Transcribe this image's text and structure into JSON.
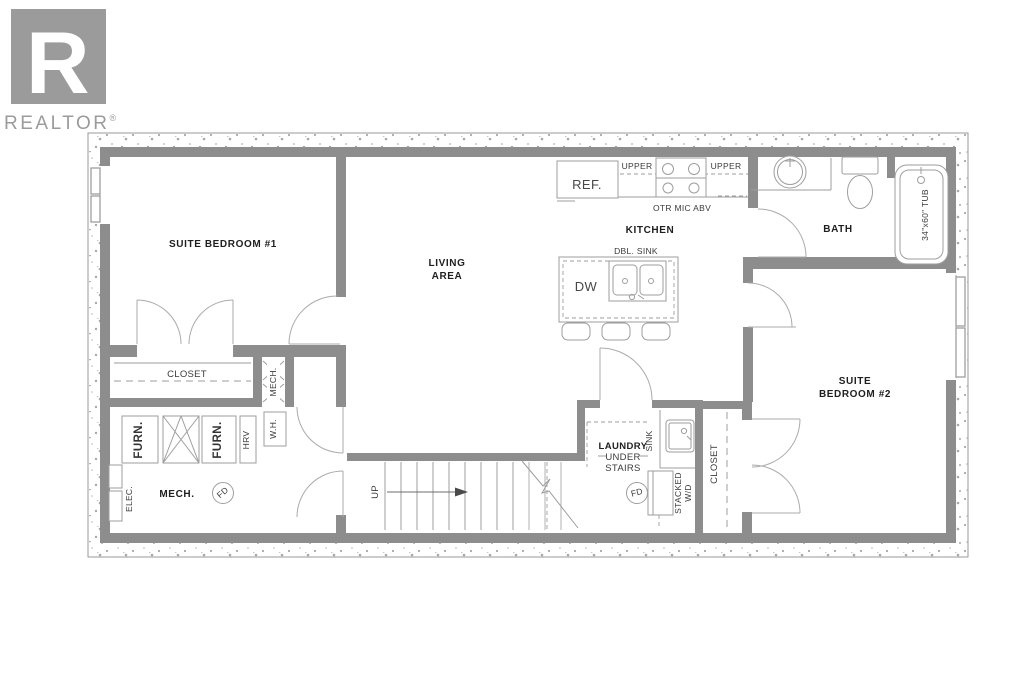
{
  "logo": {
    "letter": "R",
    "wordmark": "REALTOR",
    "registered": "®"
  },
  "rooms": {
    "bedroom1": "SUITE BEDROOM #1",
    "living_line1": "LIVING",
    "living_line2": "AREA",
    "kitchen": "KITCHEN",
    "bath": "BATH",
    "bedroom2_line1": "SUITE",
    "bedroom2_line2": "BEDROOM #2",
    "mech": "MECH.",
    "mech_chase": "MECH.",
    "laundry_line1": "LAUNDRY",
    "laundry_line2": "UNDER",
    "laundry_line3": "STAIRS",
    "closet_bedroom1": "CLOSET",
    "closet_bedroom2": "CLOSET"
  },
  "fixtures": {
    "ref": "REF.",
    "upper_left": "UPPER",
    "upper_right": "UPPER",
    "otr_mic": "OTR MIC ABV",
    "dbl_sink": "DBL. SINK",
    "dishwasher": "DW",
    "tub": "34\"x60\" TUB",
    "furnace1": "FURN.",
    "furnace2": "FURN.",
    "hrv": "HRV",
    "water_heater": "W.H.",
    "elec_panel": "ELEC.",
    "floor_drain_mech": "FD",
    "floor_drain_laundry": "FD",
    "up": "UP",
    "sink": "SINK",
    "stacked_line1": "STACKED",
    "stacked_line2": "W/D"
  },
  "colors": {
    "wall": "#8d8d8d",
    "line": "#9e9e9e",
    "door": "#ababab",
    "text": "#1f1f1f",
    "fixtext": "#3a3a3a",
    "logo": "#9b9b9b",
    "speck": "#a8a8a8"
  }
}
